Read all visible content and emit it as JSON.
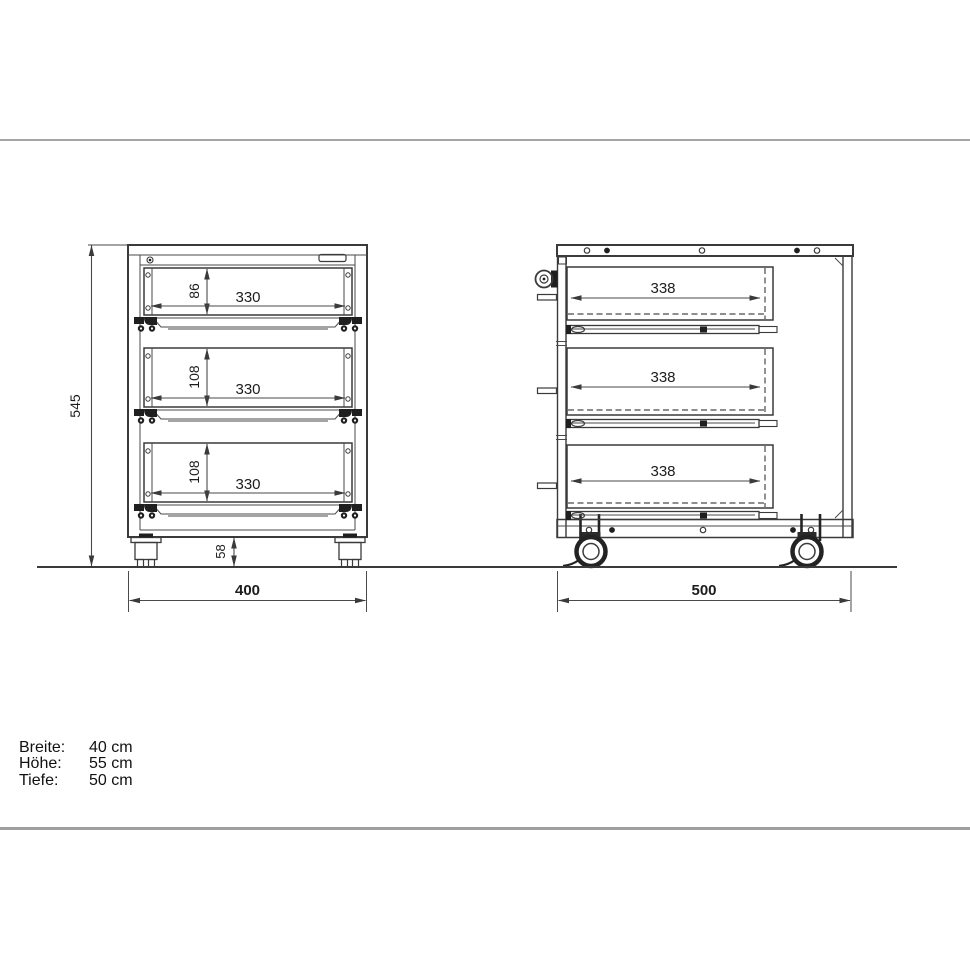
{
  "front_view": {
    "total_height": "545",
    "caster_height": "58",
    "total_width": "400",
    "drawers": [
      {
        "height": "86",
        "width": "330"
      },
      {
        "height": "108",
        "width": "330"
      },
      {
        "height": "108",
        "width": "330"
      }
    ]
  },
  "side_view": {
    "total_depth": "500",
    "drawers": [
      {
        "depth": "338"
      },
      {
        "depth": "338"
      },
      {
        "depth": "338"
      }
    ]
  },
  "specs": {
    "rows": [
      {
        "label": "Breite:",
        "value": "40 cm"
      },
      {
        "label": "Höhe:",
        "value": "55 cm"
      },
      {
        "label": "Tiefe:",
        "value": "50 cm"
      }
    ]
  },
  "colors": {
    "line": "#3a3a3a",
    "dimension": "#4a4a4a",
    "divider": "#a6a6a6",
    "background": "#ffffff"
  }
}
